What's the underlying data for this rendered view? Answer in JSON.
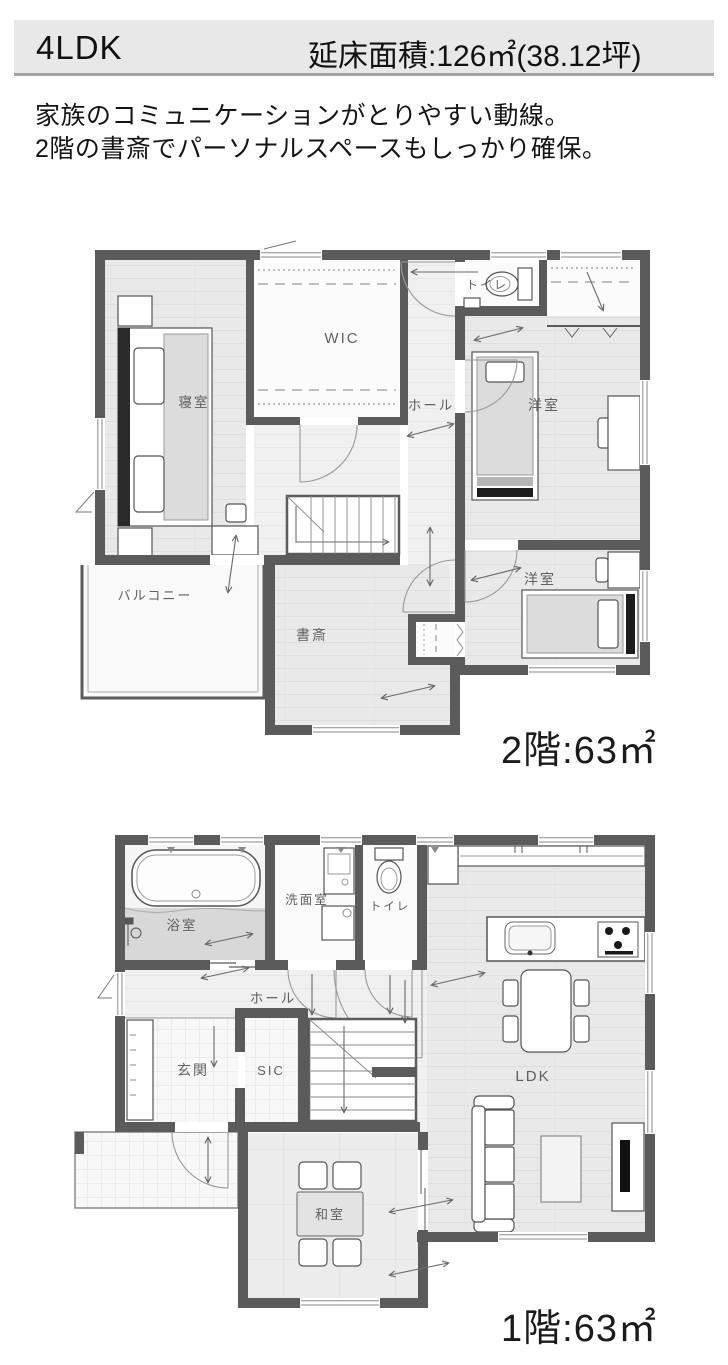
{
  "header": {
    "plan_type": "4LDK",
    "total_area_label": "延床面積:126㎡(38.12坪)"
  },
  "description": {
    "line1": "家族のコミュニケーションがとりやすい動線。",
    "line2": "2階の書斎でパーソナルスペースもしっかり確保。"
  },
  "floor2": {
    "caption": "2階:63㎡",
    "rooms": {
      "bedroom": "寝室",
      "wic": "WIC",
      "toilet": "トイレ",
      "hall": "ホール",
      "western_room_1": "洋室",
      "western_room_2": "洋室",
      "study": "書斎",
      "balcony": "バルコニー"
    }
  },
  "floor1": {
    "caption": "1階:63㎡",
    "rooms": {
      "bath": "浴室",
      "washroom": "洗面室",
      "toilet": "トイレ",
      "hall": "ホール",
      "entrance": "玄関",
      "sic": "SIC",
      "ldk": "LDK",
      "japanese_room": "和室"
    }
  },
  "colors": {
    "wall": "#5b5b5b",
    "header_bg": "#e8e8e8",
    "header_border": "#a2a2a2",
    "text_dark": "#141414",
    "room_label": "#5f5f5f"
  }
}
